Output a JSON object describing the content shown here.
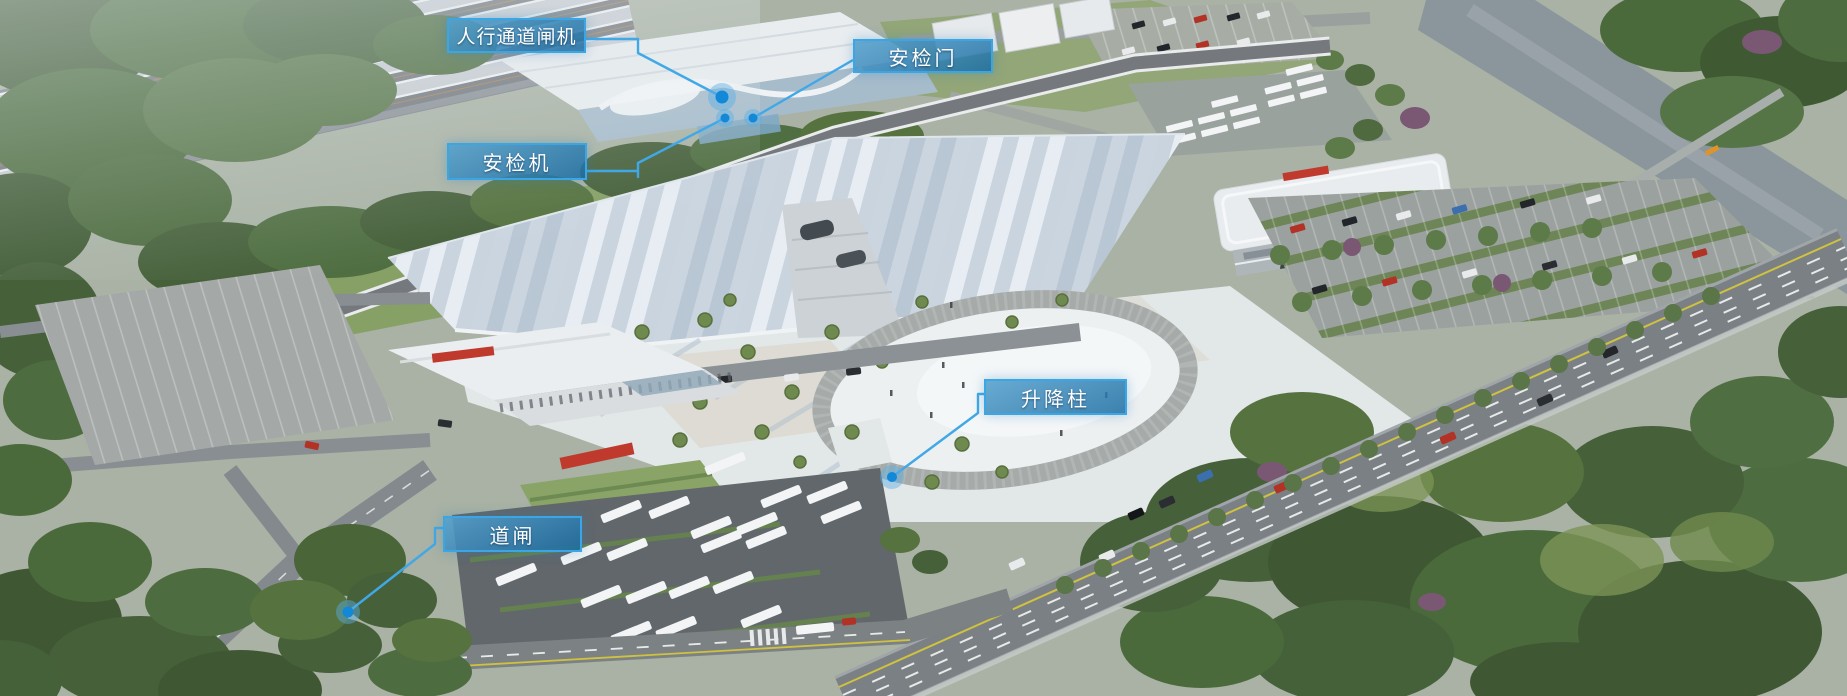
{
  "callouts": [
    {
      "id": "pedestrian-channel-gate",
      "label": "人行通道闸机"
    },
    {
      "id": "security-door",
      "label": "安检门"
    },
    {
      "id": "security-machine",
      "label": "安检机"
    },
    {
      "id": "lifting-bollard",
      "label": "升降柱"
    },
    {
      "id": "barrier-gate",
      "label": "道闸"
    }
  ],
  "colors": {
    "callout_background": "#2c80b2",
    "callout_border": "#3ba6e6",
    "callout_text": "#ffffff",
    "leader_line": "#41a8e8",
    "marker_dot": "#1288d8",
    "marker_halo": "#5ab0e4"
  }
}
